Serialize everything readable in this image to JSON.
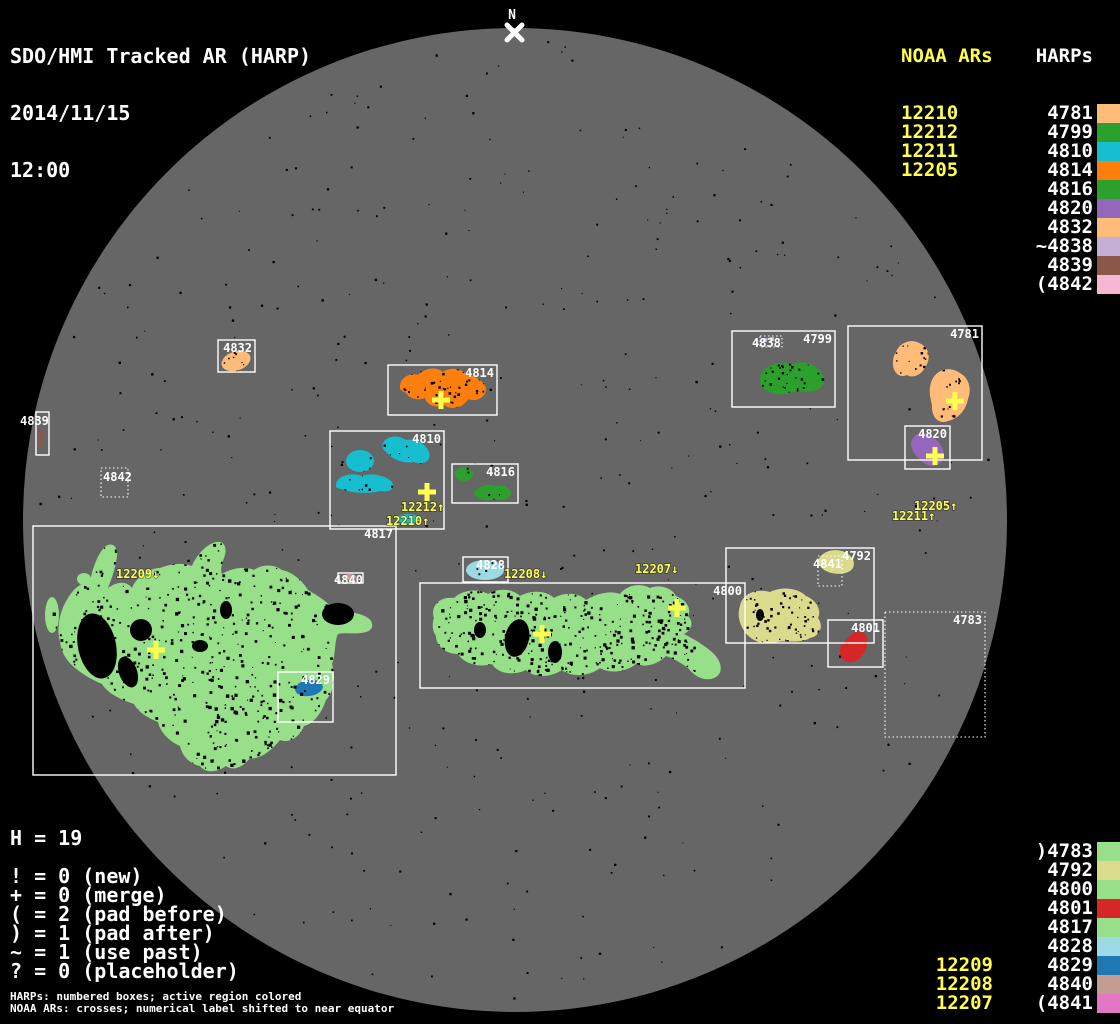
{
  "title": {
    "line1": "SDO/HMI Tracked AR (HARP)",
    "date": "2014/11/15",
    "time": "12:00"
  },
  "colors": {
    "background": "#000000",
    "disk": "#666666",
    "box_stroke": "#ffffff",
    "noaa_yellow": "#ffff4f",
    "text_white": "#ffffff"
  },
  "top_right": {
    "noaa_header": "NOAA ARs",
    "harps_header": "HARPs",
    "noaa_items": [
      "12210",
      "12212",
      "12211",
      "12205"
    ],
    "harp_items": [
      {
        "label": "4781",
        "color": "#ffbb78"
      },
      {
        "label": "4799",
        "color": "#2ca02c"
      },
      {
        "label": "4810",
        "color": "#17becf"
      },
      {
        "label": "4814",
        "color": "#ff7f0e"
      },
      {
        "label": "4816",
        "color": "#2ca02c"
      },
      {
        "label": "4820",
        "color": "#9467bd"
      },
      {
        "label": "4832",
        "color": "#ffbb78"
      },
      {
        "label": "~4838",
        "color": "#c5b0d5"
      },
      {
        "label": "4839",
        "color": "#8c564b"
      },
      {
        "label": "(4842",
        "color": "#f7b6d2"
      }
    ]
  },
  "bottom_right": {
    "harp_items": [
      {
        "label": ")4783",
        "color": "#98df8a"
      },
      {
        "label": "4792",
        "color": "#dbdb8d"
      },
      {
        "label": "4800",
        "color": "#98df8a"
      },
      {
        "label": "4801",
        "color": "#d62728"
      },
      {
        "label": "4817",
        "color": "#98df8a"
      },
      {
        "label": "4828",
        "color": "#9edae5"
      },
      {
        "label": "4829",
        "color": "#1f77b4"
      },
      {
        "label": "4840",
        "color": "#c49c94"
      },
      {
        "label": "(4841",
        "color": "#e377c2"
      }
    ],
    "noaa_items": [
      "12209",
      "12208",
      "12207"
    ]
  },
  "legend": {
    "h_count": "H = 19",
    "rows": [
      "! = 0 (new)",
      "+ = 0 (merge)",
      "( = 2 (pad before)",
      ") = 1 (pad after)",
      "~ = 1 (use past)",
      "? = 0 (placeholder)"
    ],
    "footer1": "HARPs: numbered boxes; active region colored",
    "footer2": "NOAA ARs: crosses; numerical label shifted to near equator"
  },
  "disk": {
    "north_label": "N",
    "harp_boxes": [
      {
        "label": "4832",
        "x": 218,
        "y": 340,
        "w": 37,
        "h": 32,
        "dotted": false
      },
      {
        "label": "4839",
        "x": 36,
        "y": 412,
        "w": 13,
        "h": 43,
        "dotted": false,
        "lx": 20,
        "ly": 425,
        "anchor": "start"
      },
      {
        "label": "4842",
        "x": 101,
        "y": 468,
        "w": 27,
        "h": 29,
        "dotted": true,
        "lx": 103,
        "ly": 481,
        "anchor": "start"
      },
      {
        "label": "4814",
        "x": 388,
        "y": 365,
        "w": 109,
        "h": 50,
        "dotted": false
      },
      {
        "label": "4810",
        "x": 330,
        "y": 431,
        "w": 114,
        "h": 98,
        "dotted": false
      },
      {
        "label": "4816",
        "x": 452,
        "y": 464,
        "w": 66,
        "h": 39,
        "dotted": false
      },
      {
        "label": "4817",
        "x": 33,
        "y": 526,
        "w": 363,
        "h": 249,
        "dotted": false
      },
      {
        "label": "4840",
        "x": 338,
        "y": 573,
        "w": 25,
        "h": 10,
        "dotted": false,
        "lx": 334,
        "ly": 584,
        "anchor": "start"
      },
      {
        "label": "4829",
        "x": 278,
        "y": 672,
        "w": 55,
        "h": 50,
        "dotted": false
      },
      {
        "label": "4828",
        "x": 463,
        "y": 557,
        "w": 45,
        "h": 25,
        "dotted": false
      },
      {
        "label": "4800",
        "x": 420,
        "y": 583,
        "w": 325,
        "h": 105,
        "dotted": false
      },
      {
        "label": "4792",
        "x": 726,
        "y": 548,
        "w": 148,
        "h": 95,
        "dotted": false
      },
      {
        "label": "4841",
        "x": 818,
        "y": 556,
        "w": 24,
        "h": 30,
        "dotted": true,
        "lx": 813,
        "ly": 568,
        "anchor": "start"
      },
      {
        "label": "4801",
        "x": 828,
        "y": 620,
        "w": 55,
        "h": 47,
        "dotted": false
      },
      {
        "label": "4783",
        "x": 885,
        "y": 612,
        "w": 100,
        "h": 125,
        "dotted": true
      },
      {
        "label": "4799",
        "x": 732,
        "y": 331,
        "w": 103,
        "h": 76,
        "dotted": false
      },
      {
        "label": "4838",
        "x": 760,
        "y": 336,
        "w": 22,
        "h": 11,
        "dotted": true,
        "lx": 752,
        "ly": 347,
        "anchor": "start"
      },
      {
        "label": "4781",
        "x": 848,
        "y": 326,
        "w": 134,
        "h": 134,
        "dotted": false
      },
      {
        "label": "4820",
        "x": 905,
        "y": 426,
        "w": 45,
        "h": 43,
        "dotted": false
      }
    ],
    "noaa_labels": [
      {
        "text": "12209↓",
        "x": 116,
        "y": 578
      },
      {
        "text": "12212↑",
        "x": 401,
        "y": 511
      },
      {
        "text": "12210↑",
        "x": 386,
        "y": 525
      },
      {
        "text": "12208↓",
        "x": 504,
        "y": 578
      },
      {
        "text": "12207↓",
        "x": 635,
        "y": 573
      },
      {
        "text": "12205↑",
        "x": 914,
        "y": 510
      },
      {
        "text": "12211↑",
        "x": 892,
        "y": 520
      }
    ],
    "crosses": [
      {
        "x": 441,
        "y": 400
      },
      {
        "x": 427,
        "y": 492
      },
      {
        "x": 156,
        "y": 650
      },
      {
        "x": 542,
        "y": 634
      },
      {
        "x": 677,
        "y": 608
      },
      {
        "x": 955,
        "y": 401
      },
      {
        "x": 935,
        "y": 456
      }
    ]
  }
}
